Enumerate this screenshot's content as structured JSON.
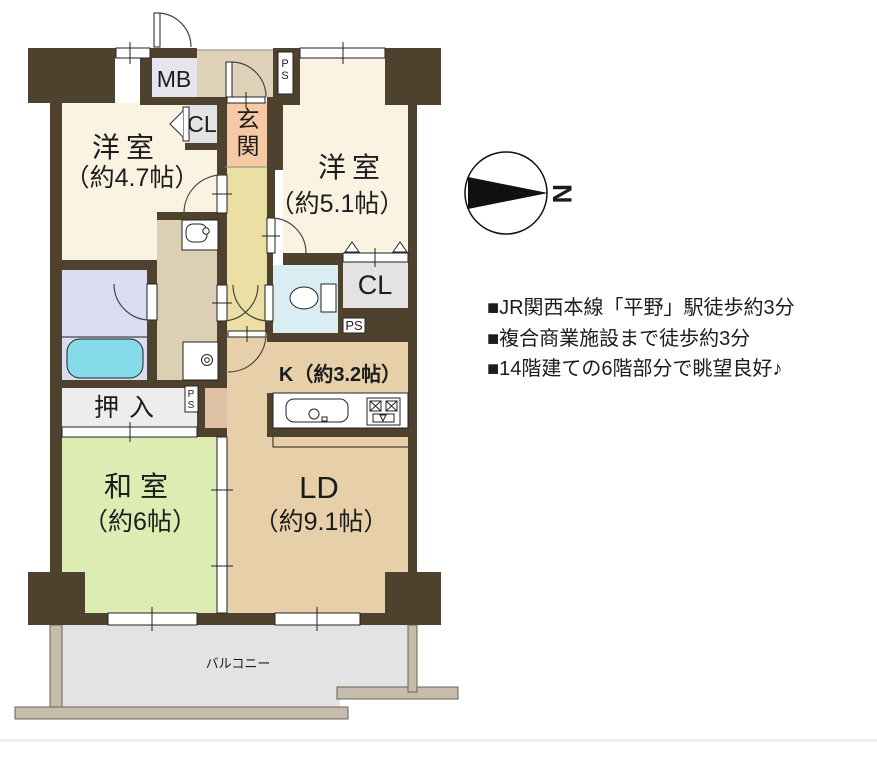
{
  "doc": {
    "type": "floor-plan",
    "compass": {
      "north_label": "N"
    }
  },
  "labels": {
    "mb": "MB",
    "cl_small": "CL",
    "cl_large": "CL",
    "ps": "PS",
    "genkan": "玄関",
    "oshiire": "押入",
    "west1_name": "洋室",
    "west1_size": "（約4.7帖）",
    "west2_name": "洋室",
    "west2_size": "（約5.1帖）",
    "washitsu_name": "和室",
    "washitsu_size": "（約6帖）",
    "ld_name": "LD",
    "ld_size": "（約9.1帖）",
    "kitchen": "K（約3.2帖）",
    "balcony": "バルコニー"
  },
  "notes": [
    "■JR関西本線「平野」駅徒歩約3分",
    "■複合商業施設まで徒歩約3分",
    "■14階建ての6階部分で眺望良好♪"
  ],
  "colors": {
    "wall": "#4e412d",
    "cream": "#faf3e2",
    "hall": "#ebdfa4",
    "porch": "#e0d2b8",
    "genkan": "#f4c9a3",
    "salmon_block": "#dfc2a6",
    "washroom": "#dccfb4",
    "ld": "#e7d0a9",
    "bath": "#dbdbf1",
    "tub": "#86dbe8",
    "toilet": "#d9edf3",
    "tatami": "#dcecb2",
    "mb_box": "#e5e5ed",
    "cl_box": "#e3e3e3",
    "oshiire_box": "#ededed",
    "balcony_floor": "#e3e3e5",
    "fence": "#c6bcab",
    "fence_edge": "#6f6250",
    "white": "#ffffff",
    "symbol": "#222222",
    "arc": "#444444",
    "faint_line": "#ececec"
  }
}
